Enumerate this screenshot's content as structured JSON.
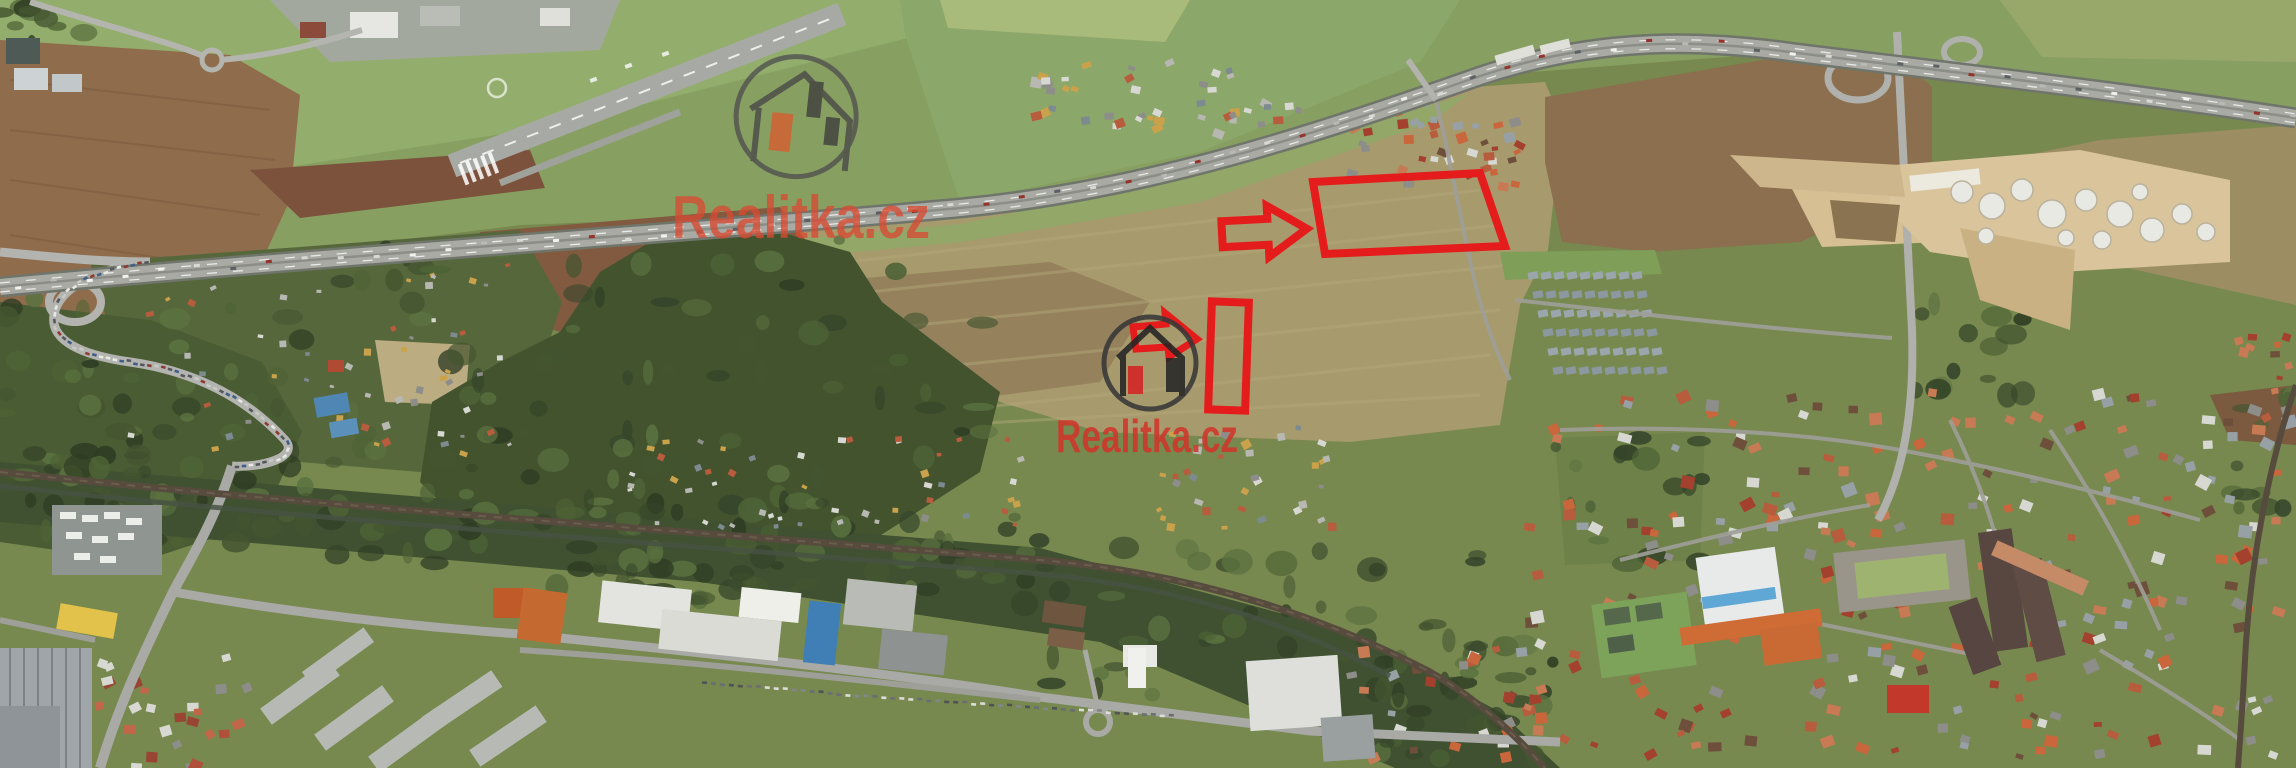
{
  "image_type": "aerial-satellite-photo",
  "watermarks": {
    "primary": {
      "text": "Realitka.cz",
      "text_color": "#d84b33",
      "logo_circle_color": "#4f4f4f",
      "house_outline_color": "#474747",
      "chimney_accent_color": "#d95b2f",
      "chimney_dark_color": "#3c3c3c"
    },
    "secondary": {
      "text": "Realitka.cz",
      "text_color": "#d0352a",
      "logo_circle_color": "#383838",
      "house_outline_color": "#242424",
      "chimney_accent_color": "#d42323",
      "chimney_dark_color": "#262626"
    }
  },
  "annotations": {
    "color": "#e51c1c",
    "items": [
      {
        "id": "parcel-outline-large",
        "type": "parcel-outline",
        "shape": "quadrilateral"
      },
      {
        "id": "parcel-outline-small",
        "type": "parcel-outline",
        "shape": "tall-rectangle"
      },
      {
        "id": "arrow-large",
        "type": "arrow-right",
        "points_at": "parcel-outline-large"
      },
      {
        "id": "arrow-small",
        "type": "arrow-right",
        "points_at": "parcel-outline-small"
      }
    ]
  },
  "icons": {
    "house_logo": "house-icon"
  },
  "palette": {
    "grass": "#8ea968",
    "field_tan": "#a79a6d",
    "field_brown": "#8a6848",
    "forest": "#42532e",
    "highway": "#a9aaa4",
    "railway": "#5a4d3f",
    "sand": "#d6bf92"
  }
}
